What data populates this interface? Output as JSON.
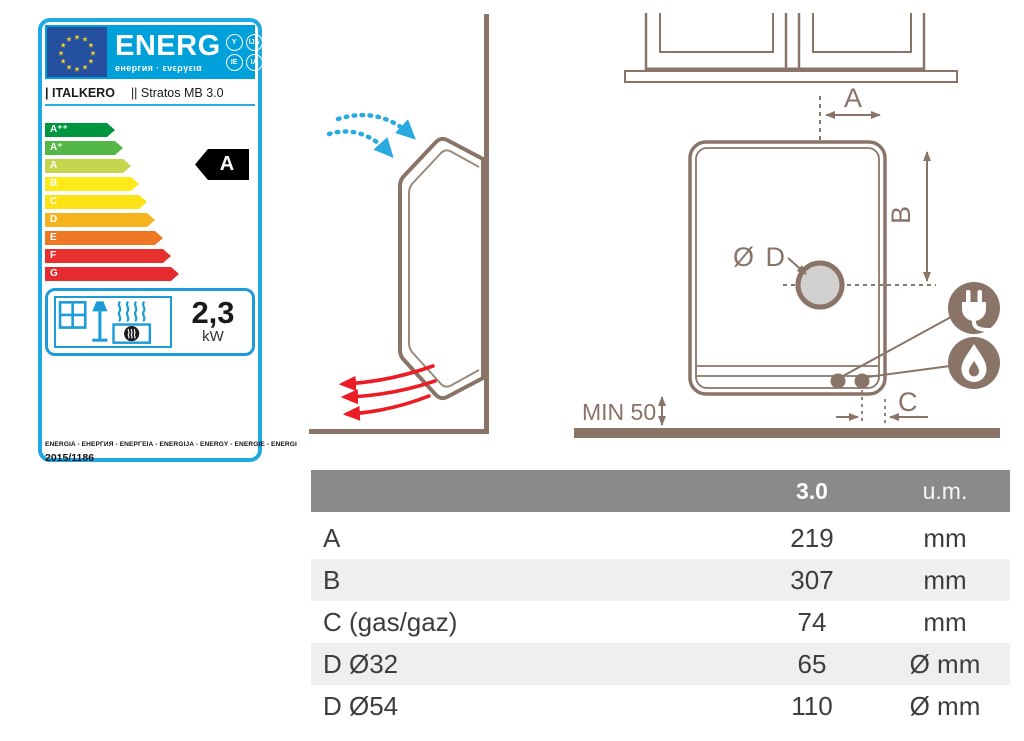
{
  "energy_label": {
    "header": {
      "title": "ENERG",
      "subtitle": "енергия · ενεργεια",
      "badges": [
        "Y",
        "IJA",
        "IE",
        "IA"
      ]
    },
    "brand": "| ITALKERO",
    "model": "|| Stratos MB 3.0",
    "scale": [
      {
        "label": "A⁺⁺",
        "color": "#00963f"
      },
      {
        "label": "A⁺",
        "color": "#54b848"
      },
      {
        "label": "A",
        "color": "#c4d64b"
      },
      {
        "label": "B",
        "color": "#fdea19"
      },
      {
        "label": "C",
        "color": "#fbe316"
      },
      {
        "label": "D",
        "color": "#f5b31d"
      },
      {
        "label": "E",
        "color": "#ed7723"
      },
      {
        "label": "F",
        "color": "#e8312e"
      },
      {
        "label": "G",
        "color": "#e52b30"
      }
    ],
    "rating": "A",
    "power_value": "2,3",
    "power_unit": "kW",
    "languages_line": "ENERGIA - ЕНЕРГИЯ - ΕΝΕΡΓΕΙΑ - ENERGIJA - ENERGY - ENERGIE - ENERGI",
    "regulation": "2015/1186",
    "colors": {
      "band_blue": "#00a0da",
      "border_blue": "#1fa9e2",
      "flag_blue": "#24509f",
      "star_yellow": "#ffd617",
      "tag_black": "#000000"
    }
  },
  "diagram": {
    "labels": {
      "dim_a": "A",
      "dim_b": "B",
      "dim_c": "C",
      "hole": "Ø D",
      "min_clearance": "MIN 50"
    },
    "colors": {
      "line_brown": "#8a7468",
      "intake_arrow_blue": "#29abe2",
      "outflow_arrow_red": "#ec1c24",
      "hole_fill_gray": "#d3d1d0"
    }
  },
  "table": {
    "header": {
      "model": "3.0",
      "unit": "u.m."
    },
    "rows": [
      {
        "label": "A",
        "value": "219",
        "unit": "mm"
      },
      {
        "label": "B",
        "value": "307",
        "unit": "mm"
      },
      {
        "label": "C (gas/gaz)",
        "value": "74",
        "unit": "mm"
      },
      {
        "label": "D  Ø32",
        "value": "65",
        "unit": "Ø mm"
      },
      {
        "label": "D  Ø54",
        "value": "110",
        "unit": "Ø mm"
      }
    ],
    "colors": {
      "header_bg": "#8a8a8c",
      "alt_row_bg": "#efefef"
    }
  }
}
